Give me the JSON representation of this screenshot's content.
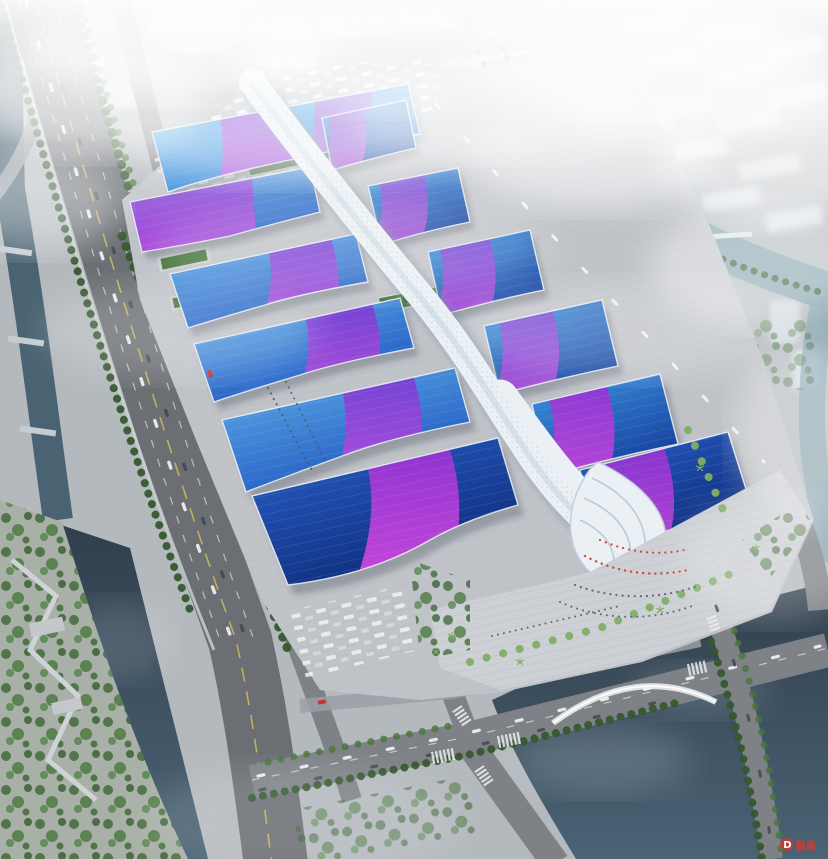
{
  "scene": {
    "type": "aerial architectural rendering",
    "subject": "riverside exhibition and convention center complex",
    "description": "Bird's-eye perspective of a long convention center running diagonally across the frame: paired exhibition halls with blue gradient roofs and violet-magenta swooshes flank a white serpentine central spine canopy that ends in a wave-shaped entrance shell at the south plaza. The site is bounded by a tree-lined highway and canal on the west, a winding teal river and hazy city towers on the east, dark rivers at the bottom corners, a truck marshalling yard at the north, and heavy white haze over the skyline."
  },
  "watermark": {
    "text": "D",
    "color": "#d03a2e",
    "position": "bottom-right"
  },
  "palette": {
    "ground": "#b4b9be",
    "plaza": "#c0c3c8",
    "plaza-light": "#cdd0d4",
    "road": "#7e8287",
    "road-dark": "#6b6f74",
    "road-light": "#9aa0a6",
    "lane-yellow": "#d4c254",
    "roof-blue-light": "#55c0f0",
    "roof-blue": "#1e6ad2",
    "roof-blue-deep": "#16409e",
    "roof-navy": "#0d2a78",
    "swoosh-violet": "#6a3cd2",
    "swoosh-magenta": "#c050dc",
    "spine-white": "#eaf0f4",
    "water-dark": "#313f4a",
    "water-mid": "#4a6372",
    "water-teal": "#7fa0ab",
    "green-dark": "#35592e",
    "green-mid": "#49763b",
    "green-light": "#7fae65",
    "building-haze": "#dde3e8",
    "flag-red": "#d03a2e"
  }
}
